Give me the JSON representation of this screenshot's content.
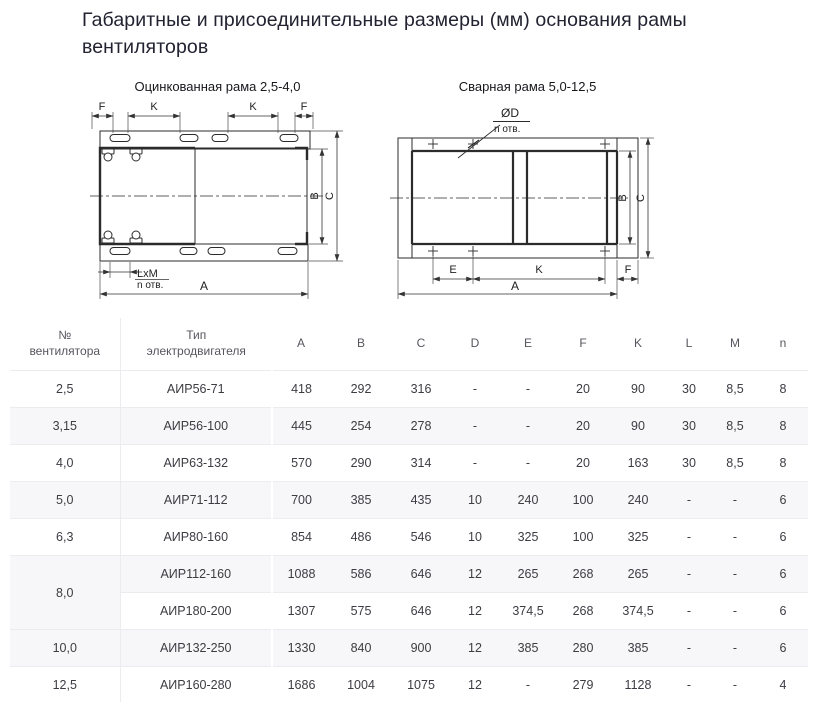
{
  "page": {
    "title_line1": "Габаритные и присоединительные размеры (мм) основания рамы",
    "title_line2": "вентиляторов"
  },
  "drawings": {
    "left": {
      "title": "Оцинкованная рама 2,5-4,0",
      "labels": {
        "f_left": "F",
        "k_left": "K",
        "k_right": "K",
        "f_right": "F",
        "b": "B",
        "c": "C",
        "a": "A",
        "lxm": "LxM",
        "n_holes": "n отв."
      }
    },
    "right": {
      "title": "Сварная рама 5,0-12,5",
      "labels": {
        "diameter": "ØD",
        "n_holes": "n отв.",
        "b": "B",
        "c": "C",
        "e": "E",
        "k": "K",
        "f": "F",
        "a": "A"
      }
    }
  },
  "table": {
    "headers": [
      "№\nвентилятора",
      "Тип\nэлектродвигателя",
      "A",
      "B",
      "C",
      "D",
      "E",
      "F",
      "K",
      "L",
      "M",
      "n"
    ],
    "rows": [
      {
        "num": "2,5",
        "rowspan": 1,
        "motor": "АИР56-71",
        "values": [
          "418",
          "292",
          "316",
          "-",
          "-",
          "20",
          "90",
          "30",
          "8,5",
          "8"
        ]
      },
      {
        "num": "3,15",
        "rowspan": 1,
        "motor": "АИР56-100",
        "values": [
          "445",
          "254",
          "278",
          "-",
          "-",
          "20",
          "90",
          "30",
          "8,5",
          "8"
        ]
      },
      {
        "num": "4,0",
        "rowspan": 1,
        "motor": "АИР63-132",
        "values": [
          "570",
          "290",
          "314",
          "-",
          "-",
          "20",
          "163",
          "30",
          "8,5",
          "8"
        ]
      },
      {
        "num": "5,0",
        "rowspan": 1,
        "motor": "АИР71-112",
        "values": [
          "700",
          "385",
          "435",
          "10",
          "240",
          "100",
          "240",
          "-",
          "-",
          "6"
        ]
      },
      {
        "num": "6,3",
        "rowspan": 1,
        "motor": "АИР80-160",
        "values": [
          "854",
          "486",
          "546",
          "10",
          "325",
          "100",
          "325",
          "-",
          "-",
          "6"
        ]
      },
      {
        "num": "8,0",
        "rowspan": 2,
        "motor": "АИР112-160",
        "values": [
          "1088",
          "586",
          "646",
          "12",
          "265",
          "268",
          "265",
          "-",
          "-",
          "6"
        ]
      },
      {
        "num": null,
        "motor": "АИР180-200",
        "values": [
          "1307",
          "575",
          "646",
          "12",
          "374,5",
          "268",
          "374,5",
          "-",
          "-",
          "6"
        ]
      },
      {
        "num": "10,0",
        "rowspan": 1,
        "motor": "АИР132-250",
        "values": [
          "1330",
          "840",
          "900",
          "12",
          "385",
          "280",
          "385",
          "-",
          "-",
          "6"
        ]
      },
      {
        "num": "12,5",
        "rowspan": 1,
        "motor": "АИР160-280",
        "values": [
          "1686",
          "1004",
          "1075",
          "12",
          "-",
          "279",
          "1128",
          "-",
          "-",
          "4"
        ]
      }
    ]
  },
  "colors": {
    "title_text": "#222231",
    "table_text": "#3c3c43",
    "header_text": "#56565e",
    "stripe": "#f7f7f9",
    "border": "#ececf0",
    "drawing_line": "#2b2b2b"
  }
}
